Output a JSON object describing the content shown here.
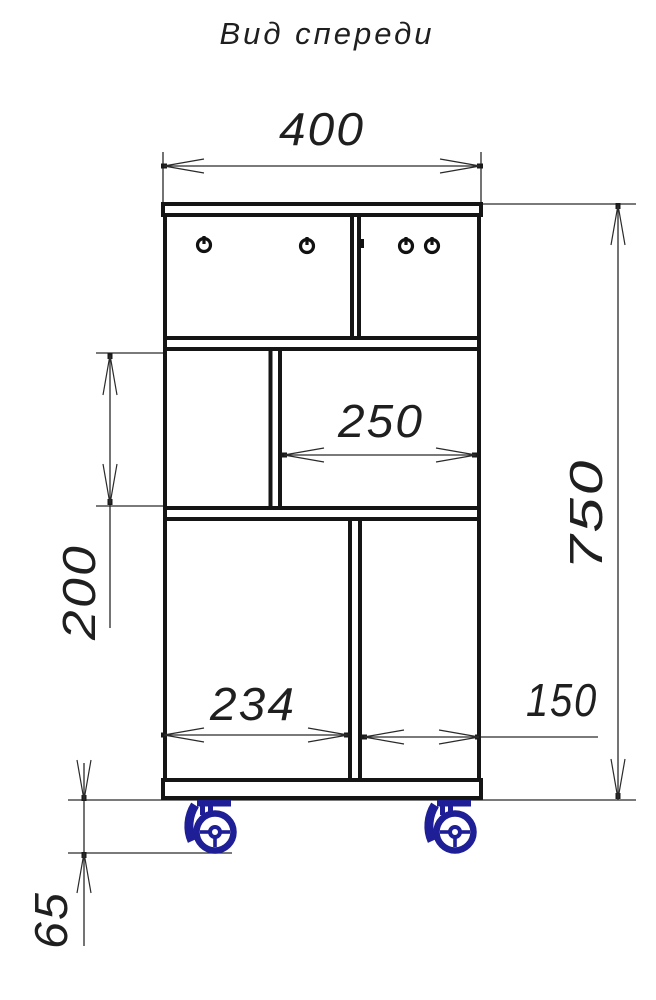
{
  "title": "Вид спереди",
  "drawing": {
    "kind": "furniture-front-view-technical-drawing",
    "units": "mm"
  },
  "dims": {
    "overall_width": "400",
    "overall_height": "750",
    "middle_right_width": "250",
    "middle_left_height": "200",
    "bottom_left_width": "234",
    "bottom_right_width": "150",
    "caster_height": "65"
  },
  "colors": {
    "line": "#151515",
    "dimension_line": "#2a2a2a",
    "caster": "#1e1e96",
    "background": "#ffffff"
  },
  "icons": {
    "caster_wheel": "caster-wheel-icon",
    "screw_knob": "screw-knob-icon"
  }
}
